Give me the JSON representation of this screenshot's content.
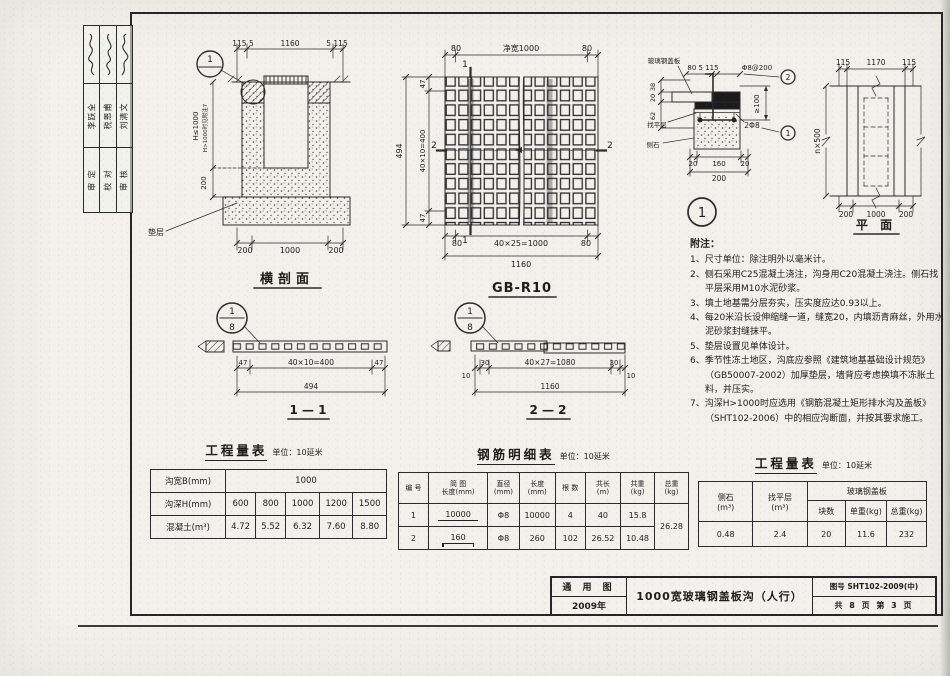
{
  "sign_strip": {
    "columns": [
      {
        "role": "审 定",
        "name": "李跃全"
      },
      {
        "role": "校 对",
        "name": "税恩甫"
      },
      {
        "role": "审 核",
        "name": "刘清文"
      }
    ]
  },
  "cross_section": {
    "title": "横剖面",
    "dim_top_left": "115 5",
    "dim_top_mid": "1160",
    "dim_top_right": "5 115",
    "dim_h_main": "H≤1000",
    "dim_h_note": "H>1000时见附注7",
    "dim_wall": "200",
    "dim_bottom_left": "200",
    "dim_bottom_mid": "1000",
    "dim_bottom_right": "200",
    "cushion_label": "垫层",
    "detail_mark": "1"
  },
  "grid_plate": {
    "title": "GB-R10",
    "dim_top_left": "80",
    "dim_top_mid": "净宽1000",
    "dim_top_right": "80",
    "dim_left_total": "494",
    "dim_left_top": "47",
    "dim_left_mid": "40×10=400",
    "dim_left_bottom": "47",
    "dim_bottom_left": "80",
    "dim_bottom_mid": "40×25=1000",
    "dim_bottom_right": "80",
    "dim_bottom_total": "1160",
    "section1": "1",
    "section2": "2"
  },
  "detail": {
    "plate_label": "玻璃钢盖板",
    "dim_top": "80 5 115",
    "stirrup_label": "Φ8@200",
    "mark2": "2",
    "dim_right": "≥100",
    "bar_label": "2Φ8",
    "mark1": "1",
    "dim_left_1": "38",
    "dim_left_2": "20",
    "dim_left_3": "62",
    "leveling_label": "找平层",
    "curb_label": "侧石",
    "dim_b1": "20",
    "dim_b2": "160",
    "dim_b3": "20",
    "dim_b_total": "200",
    "bubble": "1"
  },
  "plan": {
    "title": "平 面",
    "dim_top_left": "115",
    "dim_top_mid": "1170",
    "dim_top_right": "115",
    "dim_left": "n×500",
    "dim_bottom_left": "200",
    "dim_bottom_mid": "1000",
    "dim_bottom_right": "200"
  },
  "section11": {
    "title": "1 — 1",
    "bubble_top": "1",
    "bubble_bottom": "8",
    "dim_left": "47",
    "dim_mid": "40×10=400",
    "dim_right": "47",
    "dim_total": "494"
  },
  "section22": {
    "title": "2 — 2",
    "bubble_top": "1",
    "bubble_bottom": "8",
    "dim_1": "10",
    "dim_2": "30",
    "dim_mid": "40×27=1080",
    "dim_4": "30",
    "dim_5": "10",
    "dim_total": "1160"
  },
  "notes": {
    "title": "附注：",
    "items": [
      "1、尺寸单位：除注明外以毫米计。",
      "2、侧石采用C25混凝土浇注，沟身用C20混凝土浇注。侧石找平层采用M10水泥砂浆。",
      "3、填土地基需分层夯实，压实度应达0.93以上。",
      "4、每20米沿长设伸缩缝一道，缝宽20，内填沥青麻丝，外用水泥砂浆封缝抹平。",
      "5、垫层设置见单体设计。",
      "6、季节性冻土地区，沟底应参照《建筑地基基础设计规范》（GB50007-2002）加厚垫层，墙背应考虑换填不冻胀土料，并压实。",
      "7、沟深H>1000时应选用《钢筋混凝土矩形排水沟及盖板》（SHT102-2006）中的相应沟断面，并按其要求施工。"
    ]
  },
  "qty_table": {
    "title": "工程量表",
    "unit": "单位：10延米",
    "row1_label": "沟宽B(mm)",
    "row1_value": "1000",
    "row2_label": "沟深H(mm)",
    "row2_values": [
      "600",
      "800",
      "1000",
      "1200",
      "1500"
    ],
    "row3_label": "混凝土(m³)",
    "row3_values": [
      "4.72",
      "5.52",
      "6.32",
      "7.60",
      "8.80"
    ]
  },
  "rebar_table": {
    "title": "钢筋明细表",
    "unit": "单位：10延米",
    "h_no": "编 号",
    "h_sketch": "简 图",
    "h_sketch2": "长度(mm)",
    "h_dia": "直径",
    "h_dia2": "(mm)",
    "h_len": "长度",
    "h_len2": "(mm)",
    "h_count": "根 数",
    "h_tlen": "共长",
    "h_tlen2": "(m)",
    "h_wt": "共重",
    "h_wt2": "(kg)",
    "h_total": "总重",
    "h_total2": "(kg)",
    "rows": [
      {
        "no": "1",
        "sketch": "10000",
        "dia": "Φ8",
        "len": "10000",
        "count": "4",
        "tlen": "40",
        "wt": "15.8"
      },
      {
        "no": "2",
        "sketch": "160",
        "dia": "Φ8",
        "len": "260",
        "count": "102",
        "tlen": "26.52",
        "wt": "10.48"
      }
    ],
    "grand_total": "26.28"
  },
  "qty_table_right": {
    "title": "工程量表",
    "unit": "单位：10延米",
    "col1": "侧石",
    "col1u": "(m³)",
    "col2": "找平层",
    "col2u": "(m³)",
    "group": "玻璃钢盖板",
    "sub1": "块数",
    "sub2": "单重(kg)",
    "sub3": "总重(kg)",
    "v1": "0.48",
    "v2": "2.4",
    "v3": "20",
    "v4": "11.6",
    "v5": "232"
  },
  "title_block": {
    "type_label": "通 用 图",
    "year": "2009年",
    "drawing_title": "1000宽玻璃钢盖板沟（人行）",
    "number": "图号 SHT102-2009(中)",
    "pages": "共 8 页 第 3 页"
  }
}
